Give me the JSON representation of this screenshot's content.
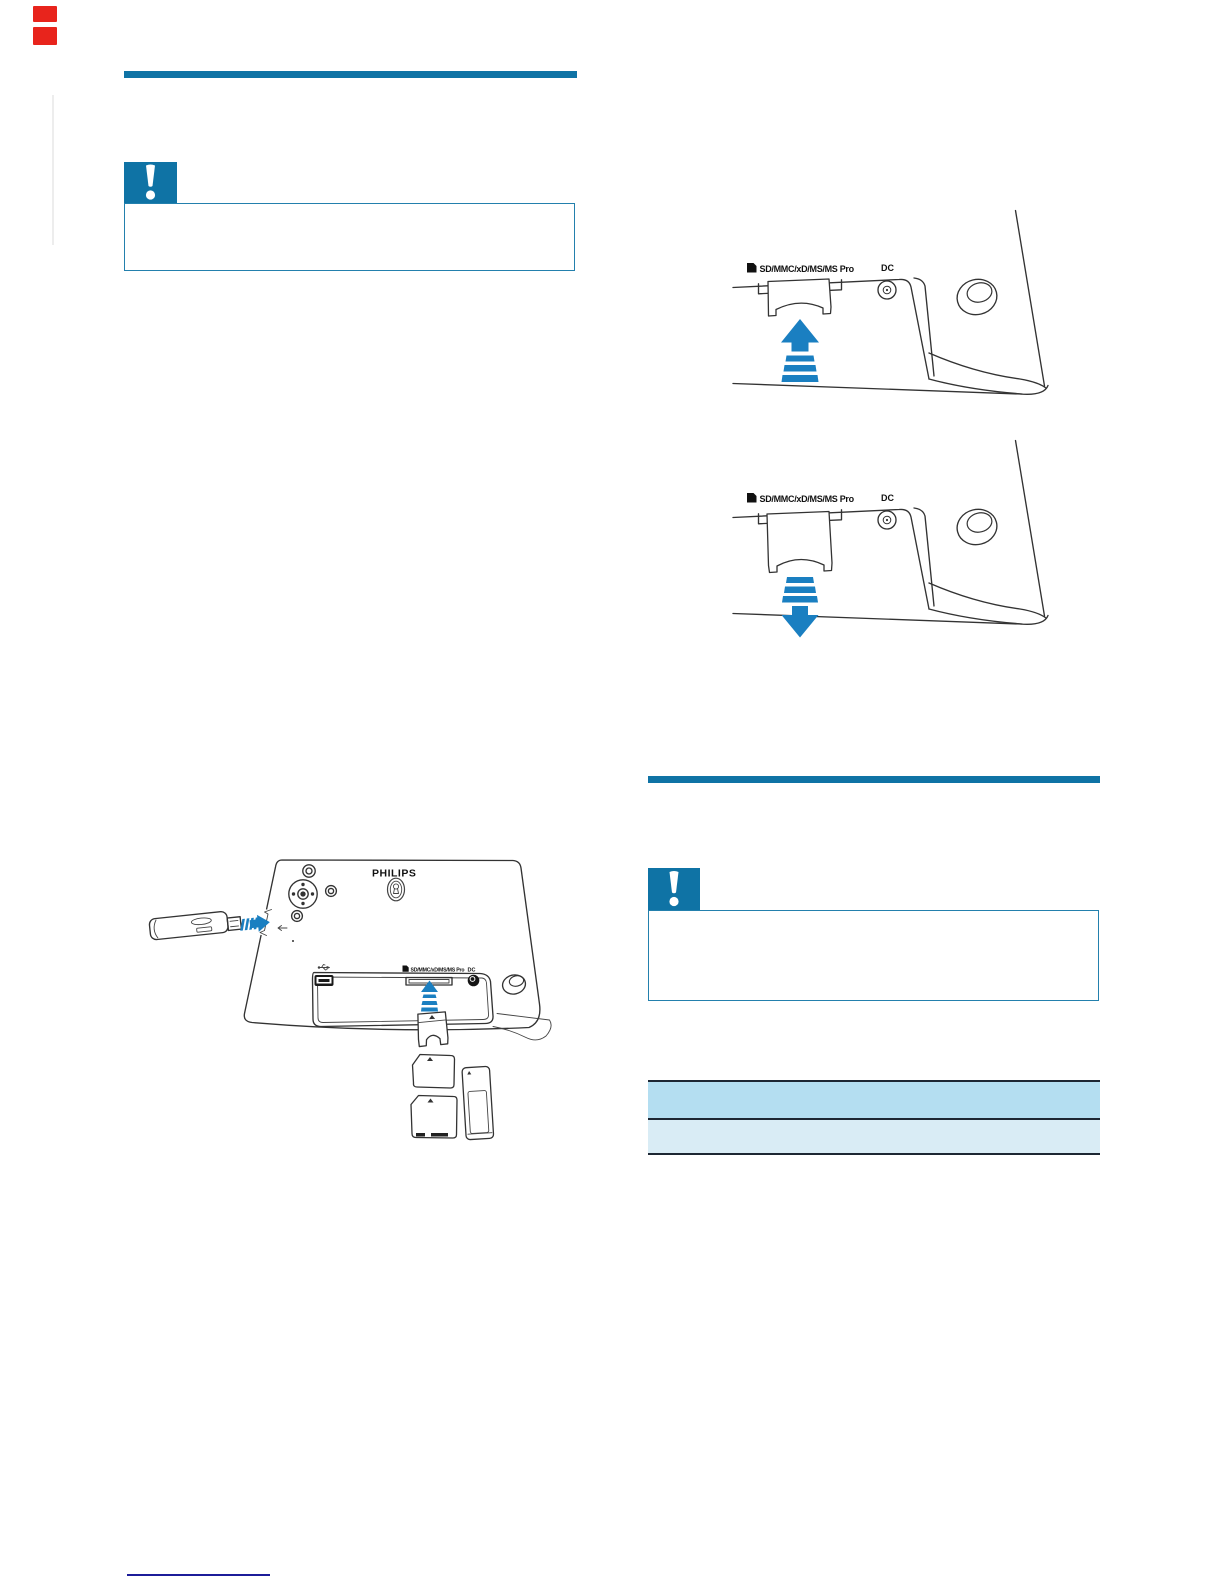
{
  "page": {
    "background": "#ffffff"
  },
  "colors": {
    "brand_blue": "#0f73a5",
    "caution_border": "#2380ad",
    "arrow_blue": "#1a7fc1",
    "line_art": "#333333",
    "table_border": "#1d2733",
    "table_header_bg": "#b4def1",
    "table_row_bg": "#d9ecf5",
    "footer_rule_navy": "#1c1c99",
    "red_marker": "#e8241c",
    "icon_black": "#111111"
  },
  "left_column": {
    "caution": {
      "icon": "exclamation-icon"
    },
    "frame_illustration": {
      "brand": "PHILIPS",
      "panel_slot_label": "SD/MMC/xD/MS/MS Pro",
      "panel_dc_label": "DC"
    }
  },
  "right_column": {
    "figure_insert_card": {
      "slot_label": "SD/MMC/xD/MS/MS Pro",
      "dc_label": "DC",
      "arrow_direction": "up"
    },
    "figure_remove_card": {
      "slot_label": "SD/MMC/xD/MS/MS Pro",
      "dc_label": "DC",
      "arrow_direction": "down"
    },
    "caution": {
      "icon": "exclamation-icon"
    },
    "spec_table": {
      "row_count": 2
    }
  }
}
